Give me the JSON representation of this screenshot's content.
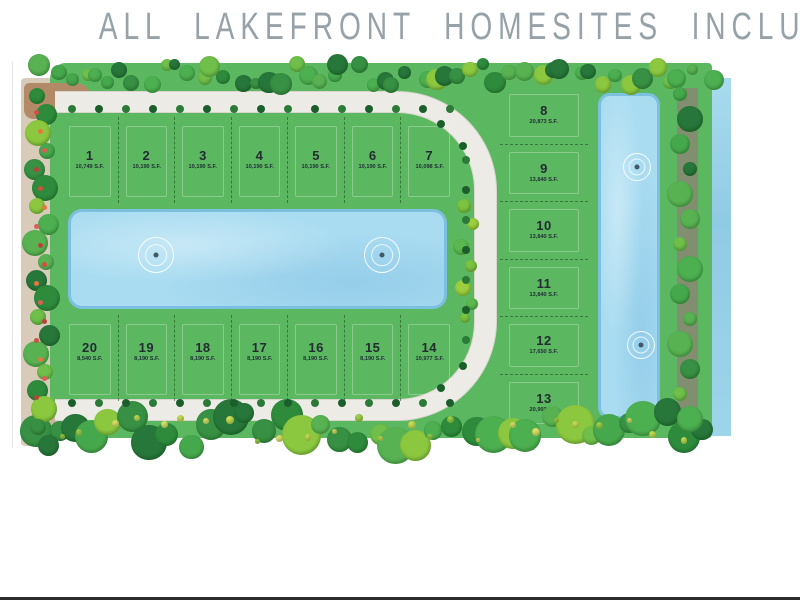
{
  "page": {
    "title": "ALL LAKEFRONT HOMESITES INCLUDED"
  },
  "site_plan": {
    "lots": {
      "north_row": [
        {
          "number": "1",
          "area": "10,749 S.F."
        },
        {
          "number": "2",
          "area": "10,190 S.F."
        },
        {
          "number": "3",
          "area": "10,190 S.F."
        },
        {
          "number": "4",
          "area": "10,190 S.F."
        },
        {
          "number": "5",
          "area": "10,190 S.F."
        },
        {
          "number": "6",
          "area": "10,190 S.F."
        },
        {
          "number": "7",
          "area": "10,098 S.F."
        }
      ],
      "south_row": [
        {
          "number": "20",
          "area": "8,540 S.F."
        },
        {
          "number": "19",
          "area": "8,190 S.F."
        },
        {
          "number": "18",
          "area": "8,190 S.F."
        },
        {
          "number": "17",
          "area": "8,190 S.F."
        },
        {
          "number": "16",
          "area": "8,190 S.F."
        },
        {
          "number": "15",
          "area": "8,190 S.F."
        },
        {
          "number": "14",
          "area": "10,977 S.F."
        }
      ],
      "east_column": [
        {
          "number": "8",
          "area": "20,873 S.F."
        },
        {
          "number": "9",
          "area": "13,840 S.F."
        },
        {
          "number": "10",
          "area": "13,840 S.F."
        },
        {
          "number": "11",
          "area": "13,840 S.F."
        },
        {
          "number": "12",
          "area": "17,650 S.F."
        },
        {
          "number": "13",
          "area": "20,903 S.F."
        }
      ]
    },
    "features": {
      "central_lake": {
        "label": "central lake",
        "fountain_count": 2
      },
      "east_lake": {
        "label": "east lake",
        "fountain_count": 2
      },
      "canal": {
        "label": "perimeter canal"
      }
    },
    "colors": {
      "lot_green": "#5cb761",
      "road": "#edebe6",
      "lake_fill": "#a9dcf1",
      "lake_edge": "#7cc0df",
      "tan_road": "#d8cbb9",
      "title_gray": "#96a1a8"
    }
  }
}
